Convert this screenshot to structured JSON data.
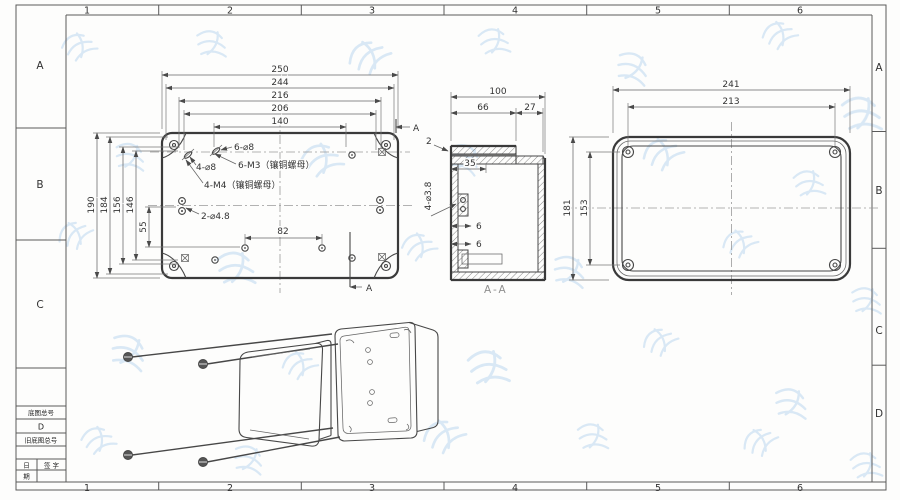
{
  "sheet": {
    "cols": [
      "1",
      "2",
      "3",
      "4",
      "5",
      "6"
    ],
    "rows_left": [
      "A",
      "B",
      "C"
    ],
    "rows_right": [
      "A",
      "B",
      "C",
      "D"
    ]
  },
  "title_block": {
    "base_drawing_no_label": "底图总号",
    "revision": "D",
    "old_drawing_no_label": "旧底图总号",
    "date_top": "日",
    "date_bottom": "期",
    "signature_label": "签 字"
  },
  "base_view": {
    "h_dims": [
      "250",
      "244",
      "216",
      "206",
      "140"
    ],
    "v_dims": [
      "190",
      "184",
      "156",
      "146",
      "55"
    ],
    "dim_82": "82",
    "note_6_d8": "6-⌀8",
    "note_4_d8": "4-⌀8",
    "note_6_m3": "6-M3（镶铜螺母）",
    "note_4_m4": "4-M4（镶铜螺母）",
    "note_2_d48": "2-⌀4.8",
    "section_label": "A"
  },
  "section_view": {
    "dim_100": "100",
    "dim_66": "66",
    "dim_27": "27",
    "dim_2": "2",
    "dim_35": "35",
    "note_4_d38": "4-⌀3.8",
    "dim_6_upper": "6",
    "dim_6_lower": "6",
    "label": "A-A"
  },
  "lid_view": {
    "dim_241": "241",
    "dim_213": "213",
    "dim_181": "181",
    "dim_153": "153"
  },
  "colors": {
    "outline": "#3a3a3a",
    "dimension": "#555555",
    "watermark": "#bcd7ee"
  }
}
